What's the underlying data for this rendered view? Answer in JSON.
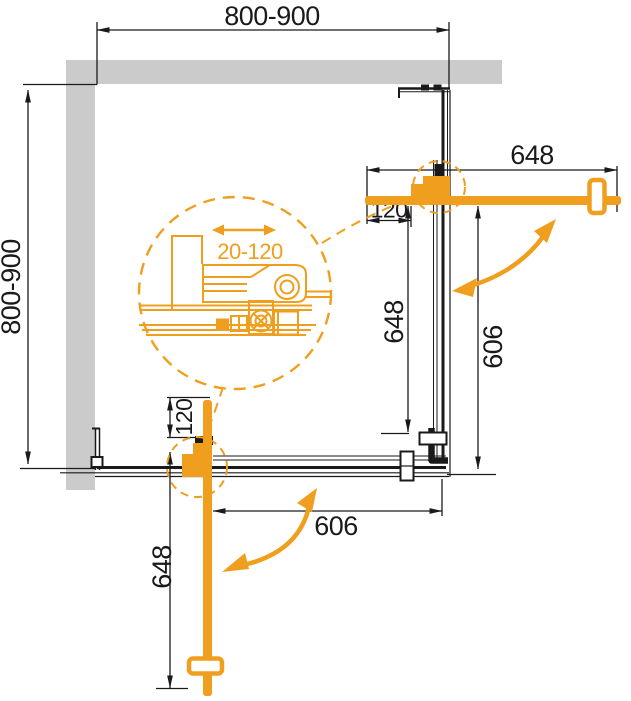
{
  "dims": {
    "top_width": "800-900",
    "left_depth": "800-900",
    "door_right_width": "648",
    "door_right_offset": "120",
    "side_right_fixed": "648",
    "opening_right": "606",
    "door_bottom_width": "648",
    "door_bottom_offset": "120",
    "opening_bottom": "606",
    "roller_adjustment": "20-120"
  },
  "colors": {
    "accent_orange": "#F09E1E",
    "wall_gray": "#CBCBCB",
    "line_black": "#1A1A1A",
    "background": "#FFFFFF"
  }
}
